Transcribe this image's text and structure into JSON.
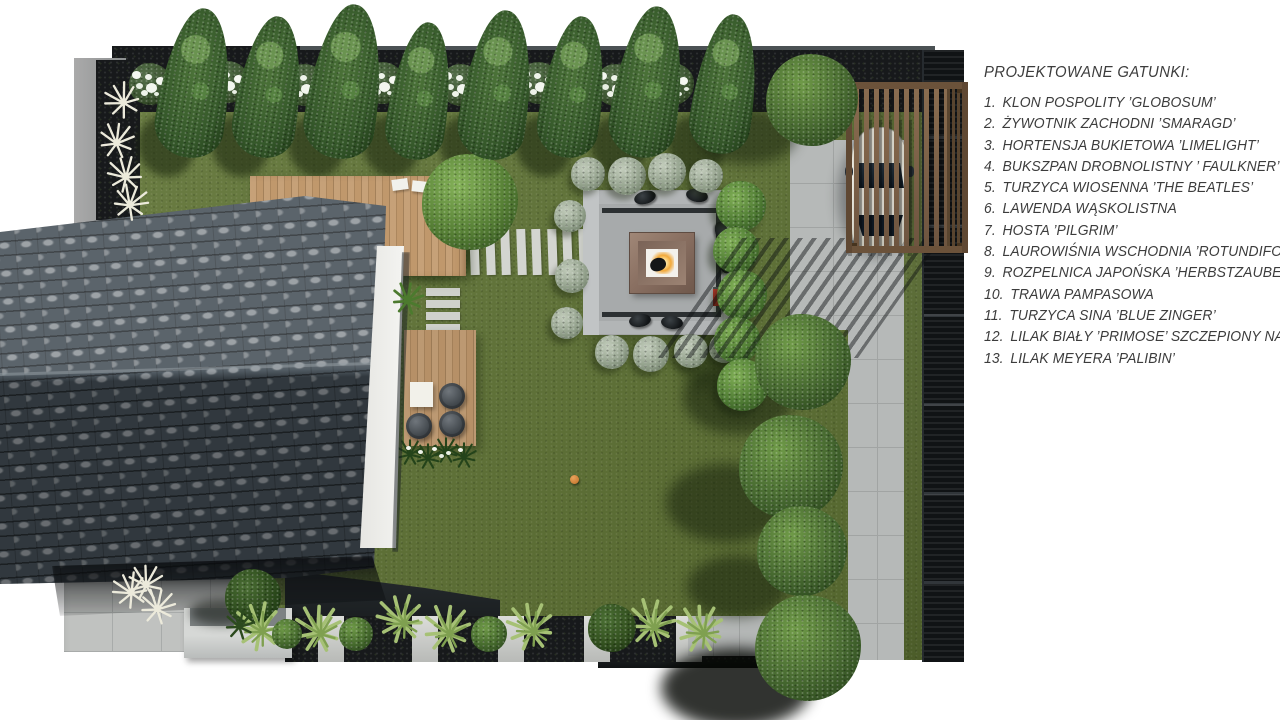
{
  "legend": {
    "title": "PROJEKTOWANE GATUNKI:",
    "items": [
      {
        "number": "1.",
        "label": "KLON POSPOLITY ’GLOBOSUM’"
      },
      {
        "number": "2.",
        "label": "ŻYWOTNIK ZACHODNI ’SMARAGD’"
      },
      {
        "number": "3.",
        "label": "HORTENSJA BUKIETOWA ’LIMELIGHT’"
      },
      {
        "number": "4.",
        "label": "BUKSZPAN DROBNOLISTNY ’ FAULKNER’"
      },
      {
        "number": "5.",
        "label": "TURZYCA WIOSENNA ’THE BEATLES’"
      },
      {
        "number": "6.",
        "label": "LAWENDA WĄSKOLISTNA"
      },
      {
        "number": "7.",
        "label": "HOSTA ’PILGRIM’"
      },
      {
        "number": "8.",
        "label": "LAUROWIŚNIA WSCHODNIA ’ROTUNDIFOLIA’"
      },
      {
        "number": "9.",
        "label": "ROZPELNICA JAPOŃSKA ’HERBSTZAUBER’"
      },
      {
        "number": "10.",
        "label": "TRAWA PAMPASOWA"
      },
      {
        "number": "11.",
        "label": "TURZYCA SINA ’BLUE ZINGER’"
      },
      {
        "number": "12.",
        "label": "LILAK BIAŁY ’PRIMOSE’ SZCZEPIONY NA PNIU"
      },
      {
        "number": "13.",
        "label": "LILAK MEYERA ’PALIBIN’"
      }
    ]
  },
  "colors": {
    "lawn": "#5e7233",
    "roof_tiles": "#434d55",
    "deck_wood": "#bf9669",
    "paving": "#b6b9b8",
    "fence": "#101315",
    "pergola_wood": "#8a6d50",
    "car_body": "#ece9dd",
    "fire_glow": "#f2a93b",
    "patio_concrete": "#b2b5b6"
  }
}
